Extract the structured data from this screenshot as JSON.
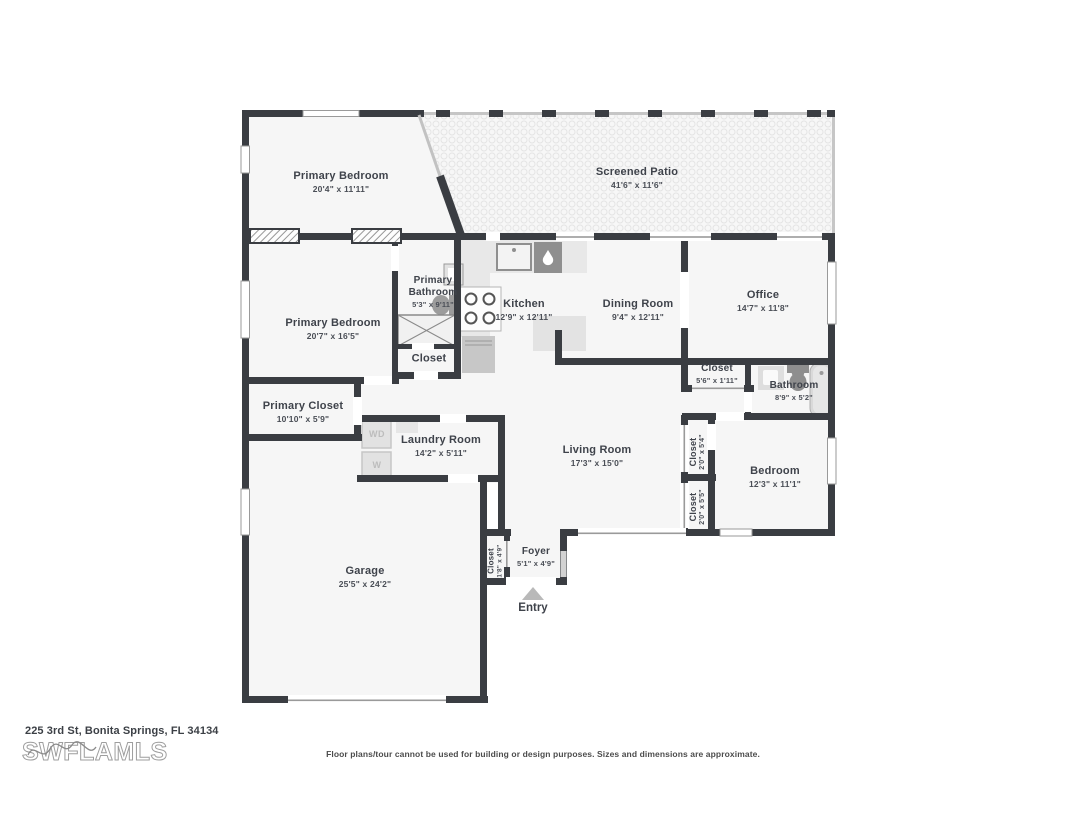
{
  "plan": {
    "rooms": [
      {
        "id": "primary-bedroom-upper",
        "name": "Primary Bedroom",
        "dims": "20'4\" x 11'11\""
      },
      {
        "id": "screened-patio",
        "name": "Screened Patio",
        "dims": "41'6\" x 11'6\""
      },
      {
        "id": "primary-bathroom",
        "name": "Primary Bathroom",
        "dims": "5'3\" x 9'11\""
      },
      {
        "id": "kitchen",
        "name": "Kitchen",
        "dims": "12'9\" x 12'11\""
      },
      {
        "id": "dining-room",
        "name": "Dining Room",
        "dims": "9'4\" x 12'11\""
      },
      {
        "id": "office",
        "name": "Office",
        "dims": "14'7\" x 11'8\""
      },
      {
        "id": "primary-bedroom-lower",
        "name": "Primary Bedroom",
        "dims": "20'7\" x 16'5\""
      },
      {
        "id": "primary-bathroom-closet",
        "name": "Closet",
        "dims": ""
      },
      {
        "id": "hall-closet",
        "name": "Closet",
        "dims": "5'6\" x 1'11\""
      },
      {
        "id": "bathroom",
        "name": "Bathroom",
        "dims": "8'9\" x 5'2\""
      },
      {
        "id": "primary-closet",
        "name": "Primary Closet",
        "dims": "10'10\" x 5'9\""
      },
      {
        "id": "laundry-room",
        "name": "Laundry Room",
        "dims": "14'2\" x 5'11\""
      },
      {
        "id": "living-room",
        "name": "Living Room",
        "dims": "17'3\" x 15'0\""
      },
      {
        "id": "hall-closet-upper",
        "name": "Closet",
        "dims": "2'0\" x 5'4\""
      },
      {
        "id": "hall-closet-lower",
        "name": "Closet",
        "dims": "2'0\" x 5'5\""
      },
      {
        "id": "bedroom",
        "name": "Bedroom",
        "dims": "12'3\" x 11'1\""
      },
      {
        "id": "garage",
        "name": "Garage",
        "dims": "25'5\" x 24'2\""
      },
      {
        "id": "foyer-closet",
        "name": "Closet",
        "dims": "1'8\" x 4'9\""
      },
      {
        "id": "foyer",
        "name": "Foyer",
        "dims": "5'1\" x 4'9\""
      }
    ],
    "entry_label": "Entry",
    "appliances": {
      "washer_dryer": "WD",
      "washer": "W"
    }
  },
  "footer": {
    "address": "225 3rd St, Bonita Springs, FL 34134",
    "watermark": "SWFLAMLS",
    "disclaimer": "Floor plans/tour cannot be used for building or design purposes. Sizes and dimensions are approximate."
  },
  "colors": {
    "wall": "#3a3d42",
    "floor": "#f6f6f6",
    "fixture_gray": "#8f8f8f",
    "text": "#3f434b"
  }
}
